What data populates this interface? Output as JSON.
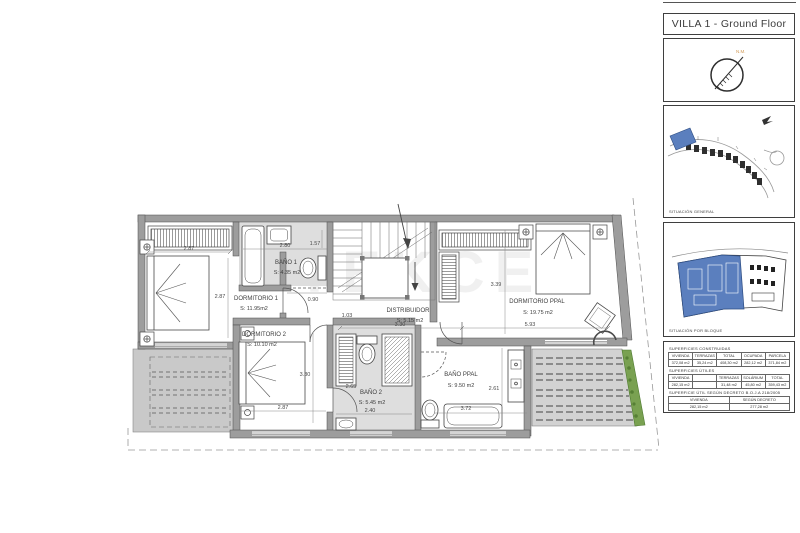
{
  "header": {
    "title": "VILLA 1 - Ground Floor"
  },
  "compass": {
    "north_label": "N.M."
  },
  "maps": {
    "general": {
      "caption": "SITUACIÓN GENERAL"
    },
    "block": {
      "caption": "SITUACIÓN POR BLOQUE"
    }
  },
  "plan": {
    "watermark": "TEKCE",
    "rooms": [
      {
        "name": "DORMITORIO 1",
        "area": "S: 11.95m2"
      },
      {
        "name": "BAÑO 1",
        "area": "S: 4.35 m2"
      },
      {
        "name": "DISTRIBUIDOR",
        "area": "S: 5.15 m2"
      },
      {
        "name": "DORMITORIO PPAL",
        "area": "S: 19.75 m2"
      },
      {
        "name": "DORMITORIO 2",
        "area": "S: 10.10 m2"
      },
      {
        "name": "BAÑO 2",
        "area": "S: 5.45 m2"
      },
      {
        "name": "BAÑO PPAL",
        "area": "S: 9.50 m2"
      }
    ],
    "dimensions": [
      "2.87",
      "2.87",
      "2.80",
      "1.57",
      "0.90",
      "1.03",
      "3.30",
      "3.39",
      "5.93",
      "3.30",
      "2.87",
      "2.65",
      "2.40",
      "2.61",
      "3.72"
    ]
  },
  "tables": {
    "constructed": {
      "title": "SUPERFICIES CONSTRUIDAS",
      "headers": [
        "VIVIENDA",
        "TERRAZAS",
        "TOTAL",
        "OCUPADA",
        "PARCELA"
      ],
      "values": [
        "372,08 m2",
        "35,24 m2",
        "408,30 m2",
        "282,12 m2",
        "371,84 m2"
      ]
    },
    "useful": {
      "title": "SUPERFICIES ÚTILES",
      "headers": [
        "VIVIENDA",
        "",
        "TERRAZAS",
        "SOLÁRIUM",
        "TOTAL"
      ],
      "values": [
        "282,15 m2",
        "",
        "31,48 m2",
        "45,80 m2",
        "359,43 m2"
      ]
    },
    "decree": {
      "title": "SUPERFICIE ÚTIL SEGÚN DECRETO B.O.J.A 218/2005",
      "headers": [
        "VIVIENDA",
        "SEGÚN DECRETO"
      ],
      "values": [
        "282,15 m2",
        "277,28 m2"
      ]
    }
  },
  "colors": {
    "wall_gray": "#9d9d9d",
    "bath_floor": "#dedede",
    "terrace_gray": "#cfcfcf",
    "highlight_blue": "#5b7fbe",
    "north_orange": "#d29a55",
    "plant_green": "#79a151"
  }
}
